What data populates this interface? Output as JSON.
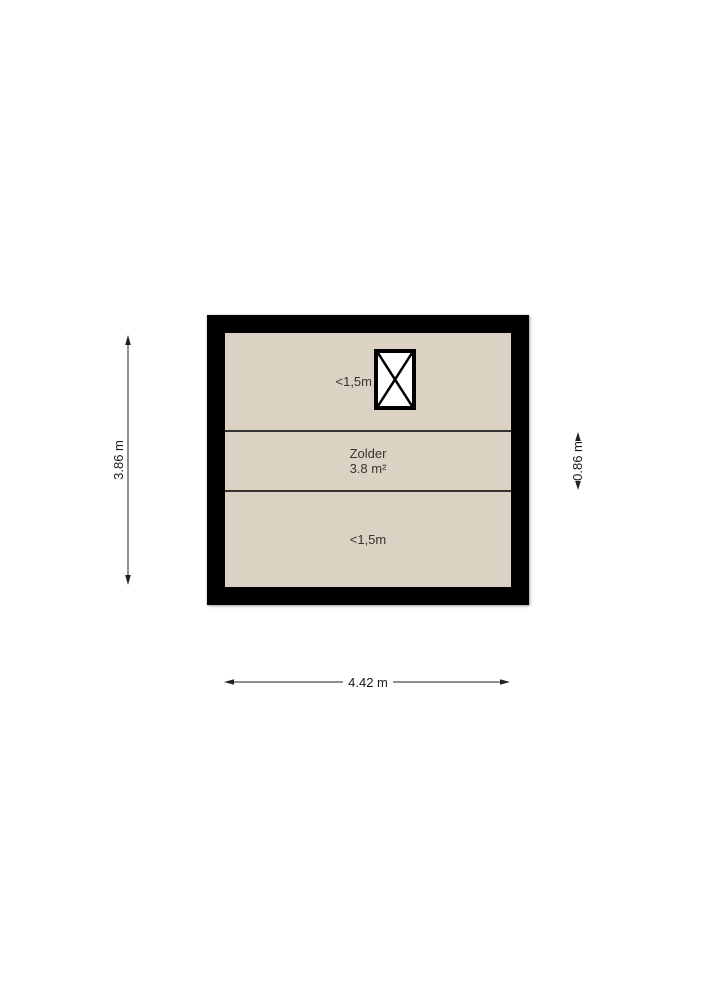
{
  "plan": {
    "room": {
      "name": "Zolder",
      "area": "3.8 m²"
    },
    "zones": {
      "top_label": "<1,5m",
      "bottom_label": "<1,5m"
    },
    "colors": {
      "floor": "#dcd2c3",
      "wall": "#000000",
      "divider": "#333333",
      "background": "#ffffff"
    },
    "icons": {
      "roof_window": "roof-window-icon (rectangle with diagonal cross)"
    }
  },
  "dimensions": {
    "total_height": "3.86 m",
    "middle_height": "0.86 m",
    "total_width": "4.42 m"
  }
}
